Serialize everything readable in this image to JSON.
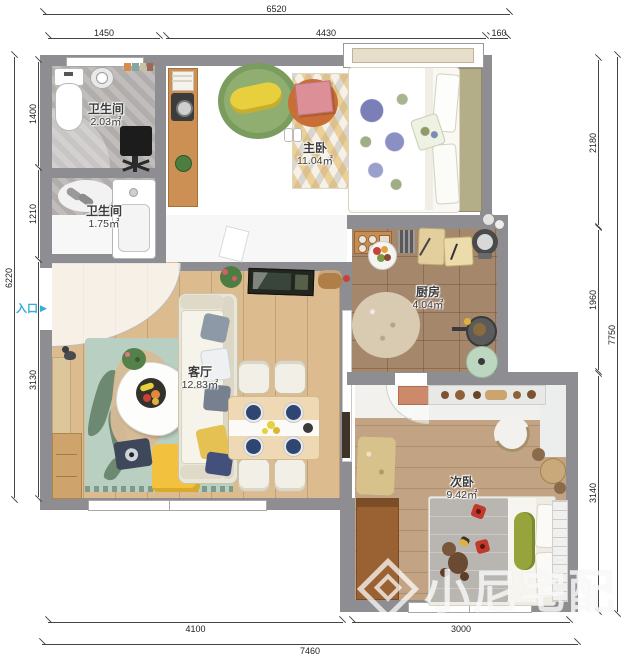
{
  "watermark": {
    "text": "小尼宅配"
  },
  "entrance": {
    "label": "入口",
    "arrow": "▶"
  },
  "dims": {
    "top_total": "6520",
    "top_seg1": "1450",
    "top_seg2": "4430",
    "top_seg3": "160",
    "left_total": "6220",
    "left_seg1": "1400",
    "left_seg2": "1210",
    "left_seg3": "3130",
    "right_total": "7750",
    "right_seg1": "2180",
    "right_seg2": "1960",
    "right_seg3": "3140",
    "bottom_total": "7460",
    "bottom_seg1": "4100",
    "bottom_seg2": "3000"
  },
  "rooms": {
    "bath1": {
      "name": "卫生间",
      "area": "2.03㎡"
    },
    "bath2": {
      "name": "卫生间",
      "area": "1.75㎡"
    },
    "master": {
      "name": "主卧",
      "area": "11.04㎡"
    },
    "kitchen": {
      "name": "厨房",
      "area": "4.04㎡"
    },
    "living": {
      "name": "客厅",
      "area": "12.83㎡"
    },
    "second": {
      "name": "次卧",
      "area": "9.42㎡"
    }
  },
  "colors": {
    "wall": "#8e8e92",
    "entrance_blue": "#35aae0",
    "dimension_text": "#222222"
  }
}
